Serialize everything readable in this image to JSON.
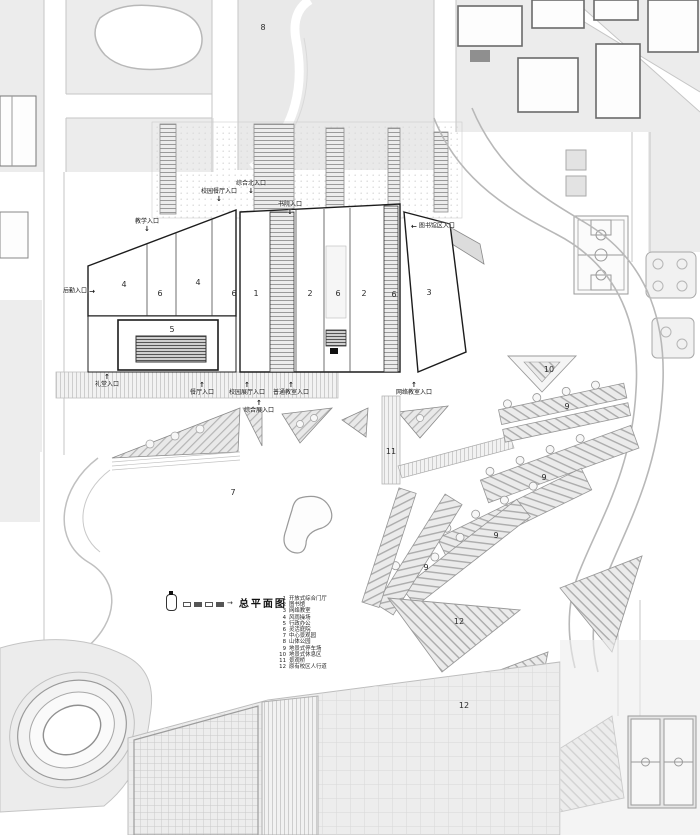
{
  "plan": {
    "title": "总平面图",
    "colors": {
      "building_outline": "#1c1c1c",
      "landscape_fill": "#ececec",
      "hatch_line": "#adadad",
      "road_edge": "#c6c6c6"
    },
    "legend": {
      "title": "总平面图",
      "items": [
        {
          "num": "1",
          "label": "开放式综合门厅"
        },
        {
          "num": "2",
          "label": "图书馆"
        },
        {
          "num": "3",
          "label": "网络教室"
        },
        {
          "num": "4",
          "label": "风雨操场"
        },
        {
          "num": "5",
          "label": "行政办公"
        },
        {
          "num": "6",
          "label": "灵活庭院"
        },
        {
          "num": "7",
          "label": "中心景观园"
        },
        {
          "num": "8",
          "label": "山体公园"
        },
        {
          "num": "9",
          "label": "地景式停车场"
        },
        {
          "num": "10",
          "label": "地景式休息区"
        },
        {
          "num": "11",
          "label": "景观桥"
        },
        {
          "num": "12",
          "label": "原有校区人行道"
        }
      ]
    },
    "entrances": [
      {
        "label": "教学入口",
        "arrow": "↓",
        "cls": "v",
        "x": 147,
        "y": 226
      },
      {
        "label": "校园餐厅入口",
        "arrow": "↓",
        "cls": "v",
        "x": 219,
        "y": 196
      },
      {
        "label": "综合北入口",
        "arrow": "↓",
        "cls": "v",
        "x": 251,
        "y": 188
      },
      {
        "label": "书院入口",
        "arrow": "↓",
        "cls": "v",
        "x": 290,
        "y": 209
      },
      {
        "label": "图书馆区入口",
        "arrow": "←",
        "cls": "hl",
        "x": 433,
        "y": 227
      },
      {
        "label": "后勤入口",
        "arrow": "→",
        "cls": "hr",
        "x": 79,
        "y": 292
      },
      {
        "label": "礼堂入口",
        "arrow": "↑",
        "cls": "vu",
        "x": 107,
        "y": 381
      },
      {
        "label": "餐厅入口",
        "arrow": "↑",
        "cls": "vu",
        "x": 202,
        "y": 389
      },
      {
        "label": "校园展厅入口",
        "arrow": "↑",
        "cls": "vu",
        "x": 247,
        "y": 389
      },
      {
        "label": "普通教室入口",
        "arrow": "↑",
        "cls": "vu",
        "x": 291,
        "y": 389
      },
      {
        "label": "综合展入口",
        "arrow": "↑",
        "cls": "vu",
        "x": 259,
        "y": 407
      },
      {
        "label": "网络教室入口",
        "arrow": "↑",
        "cls": "vu",
        "x": 414,
        "y": 389
      }
    ],
    "zones": [
      {
        "n": "8",
        "x": 263,
        "y": 28
      },
      {
        "n": "4",
        "x": 124,
        "y": 285
      },
      {
        "n": "6",
        "x": 160,
        "y": 294
      },
      {
        "n": "4",
        "x": 198,
        "y": 283
      },
      {
        "n": "6",
        "x": 234,
        "y": 294
      },
      {
        "n": "1",
        "x": 256,
        "y": 294
      },
      {
        "n": "2",
        "x": 310,
        "y": 294
      },
      {
        "n": "6",
        "x": 338,
        "y": 294
      },
      {
        "n": "2",
        "x": 364,
        "y": 294
      },
      {
        "n": "6",
        "x": 394,
        "y": 295
      },
      {
        "n": "3",
        "x": 429,
        "y": 293
      },
      {
        "n": "5",
        "x": 172,
        "y": 330
      },
      {
        "n": "10",
        "x": 549,
        "y": 370
      },
      {
        "n": "9",
        "x": 567,
        "y": 407
      },
      {
        "n": "11",
        "x": 391,
        "y": 452
      },
      {
        "n": "7",
        "x": 233,
        "y": 493
      },
      {
        "n": "9",
        "x": 544,
        "y": 478
      },
      {
        "n": "9",
        "x": 496,
        "y": 536
      },
      {
        "n": "9",
        "x": 426,
        "y": 568
      },
      {
        "n": "12",
        "x": 459,
        "y": 622
      },
      {
        "n": "12",
        "x": 464,
        "y": 706
      }
    ]
  }
}
